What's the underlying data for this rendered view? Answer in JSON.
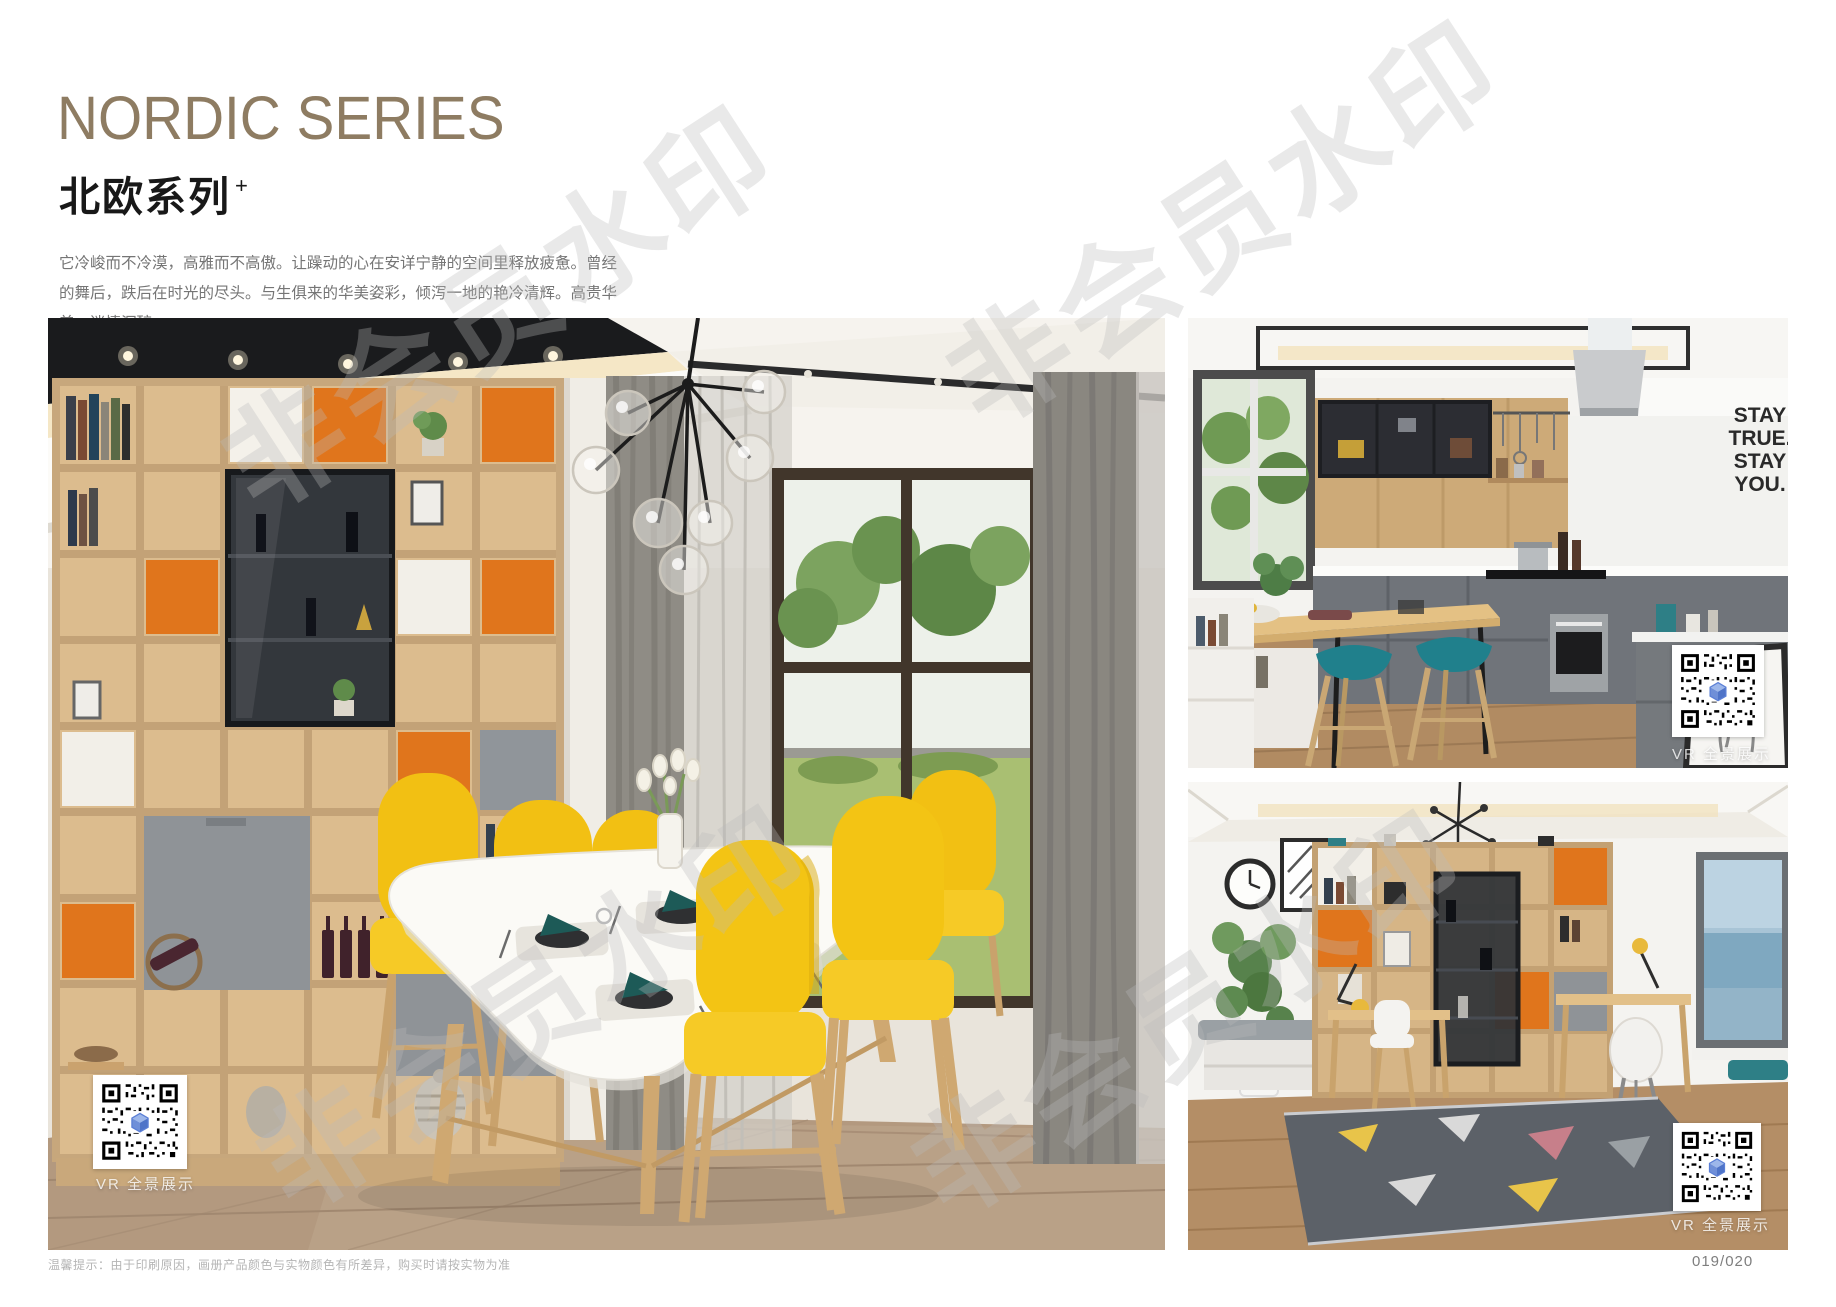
{
  "header": {
    "title_en": "NORDIC SERIES",
    "title_cn": "北欧系列",
    "title_superscript": "+",
    "desc_cn": "它冷峻而不冷漠，高雅而不高傲。让躁动的心在安详宁静的空间里释放疲惫。曾经的舞后，跌后在时光的尽头。与生俱来的华美姿彩，倾泻一地的艳冷清辉。高贵华美，迷情沉醉。",
    "desc_en": "It is cold but not cold, elegant but not haughty. Let the restless heart in the space of peace and tranquility release fatigue. Once the Queen of Dance, fall in the end of time. The natural beauty of the beautiful, pouring a land of cold and pure brilliance. Noble, beautiful, enchanted."
  },
  "watermark": {
    "text": "非会员水印"
  },
  "photos": {
    "dining": {
      "vr_label": "VR 全景展示"
    },
    "kitchen": {
      "vr_label": "VR 全景展示",
      "wall_text_lines": [
        "STAY",
        "TRUE.",
        "STAY",
        "YOU."
      ]
    },
    "study": {
      "vr_label": "VR 全景展示"
    }
  },
  "footer": {
    "note": "温馨提示：由于印刷原因，画册产品颜色与实物颜色有所差异，购买时请按实物为准",
    "page_number": "019/020"
  },
  "colors": {
    "accent_bronze": "#8e7c62",
    "chair_yellow": "#f3c414",
    "cabinet_orange": "#e0751c",
    "stool_teal": "#20808c",
    "napkin_teal": "#1d5a57"
  }
}
